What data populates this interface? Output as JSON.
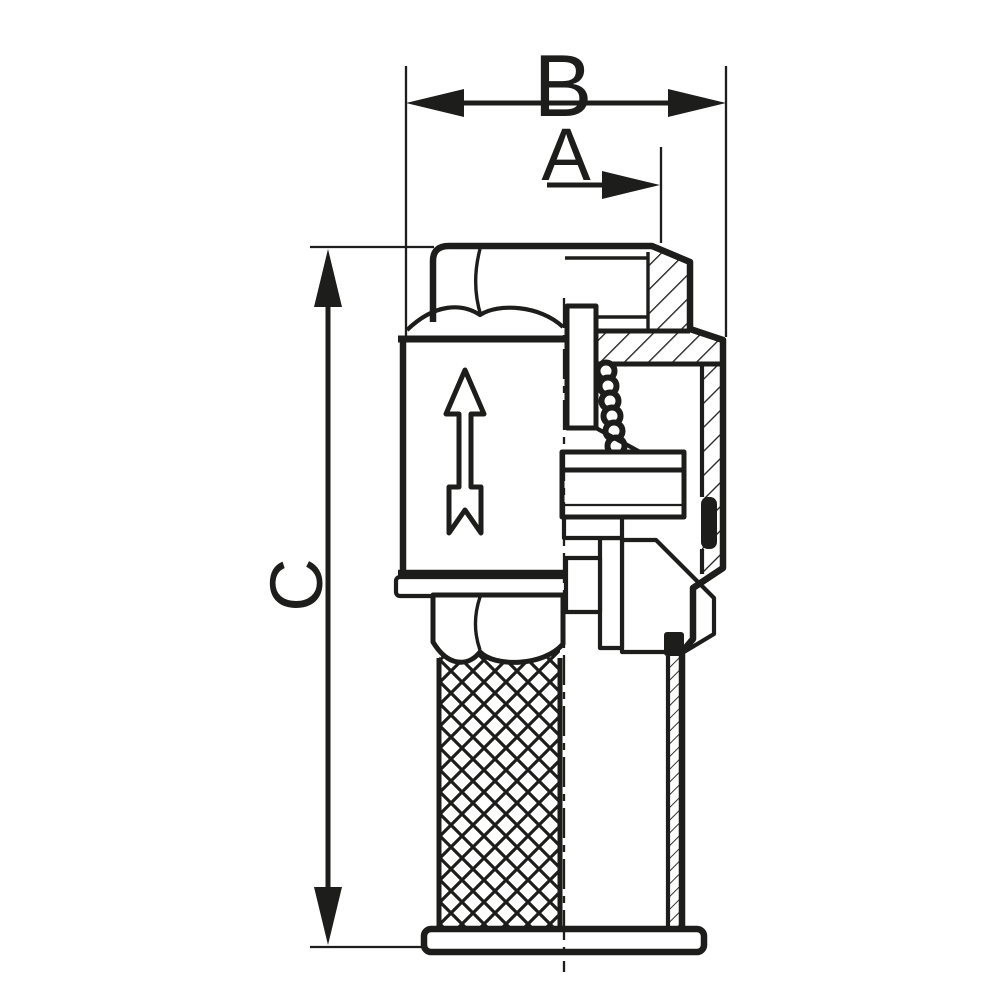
{
  "drawing": {
    "dimensions": {
      "a_label": "A",
      "b_label": "B",
      "c_label": "C"
    },
    "colors": {
      "line_color": "#1d1d1b",
      "background_color": "#ffffff"
    }
  }
}
